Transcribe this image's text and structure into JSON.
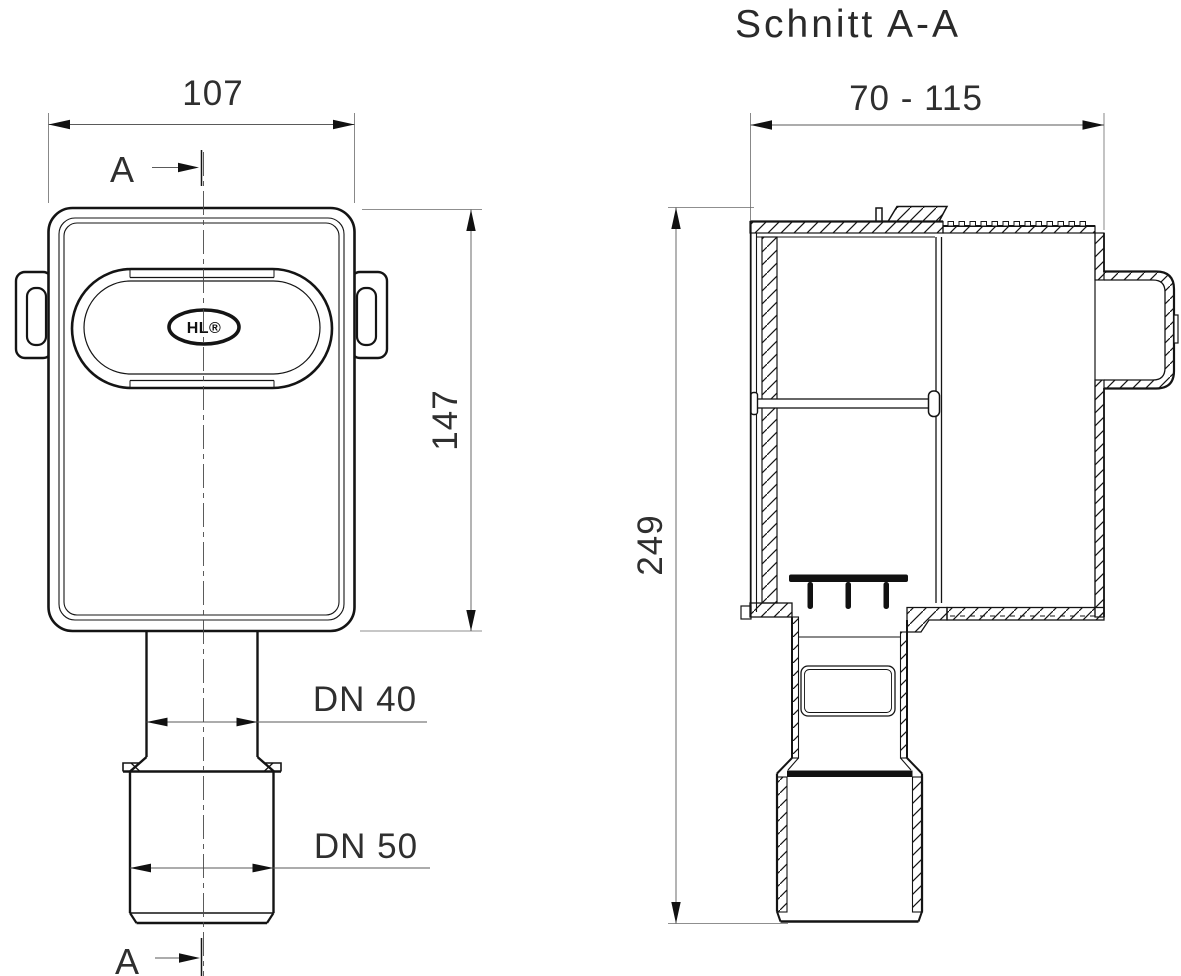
{
  "meta": {
    "background": "#ffffff",
    "line_color": "#141414",
    "dim_color": "#5a5a5a"
  },
  "front_view": {
    "logo": "HL®",
    "dim_width": "107",
    "dim_height": "147",
    "dim_outlet_upper": "DN 40",
    "dim_outlet_lower": "DN 50",
    "section_marker_top": "A",
    "section_marker_bottom": "A"
  },
  "section_view": {
    "title": "Schnitt A-A",
    "dim_width_range": "70 - 115",
    "dim_height": "249"
  }
}
